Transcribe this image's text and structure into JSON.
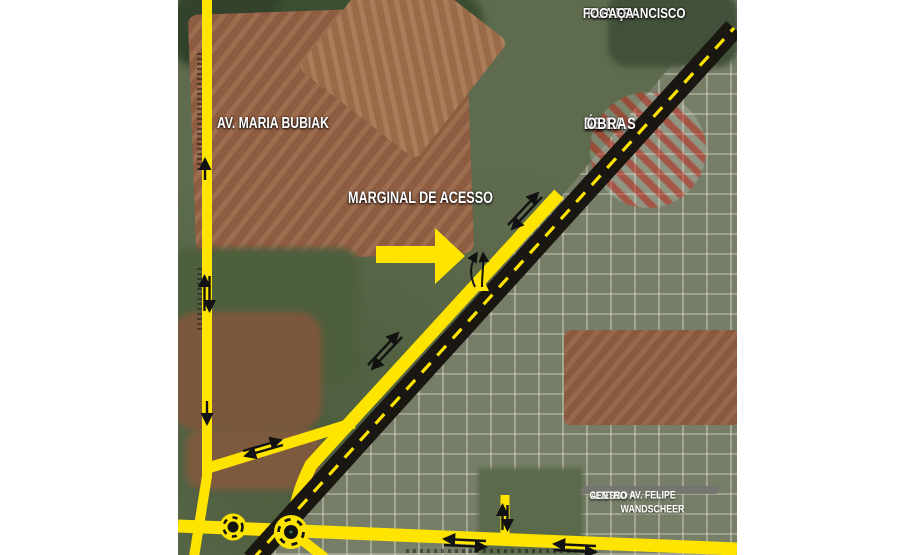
{
  "labels": {
    "rua_francisco": {
      "line1": "RUA FRANCISCO",
      "line2": "FOGAÇA"
    },
    "av_maria_bubiak": "AV. MARIA BUBIAK",
    "marginal_de_acesso": "MARGINAL DE ACESSO",
    "area_obras": {
      "line1": "ÁREA",
      "line2": "DE",
      "line3": "OBRAS"
    },
    "acesso": {
      "line1": "ACESSO A",
      "line2": "AV. FELIPE WANDSCHEER",
      "line3": "CENTRO"
    }
  },
  "colors": {
    "road_yellow": "#ffe400",
    "highway_black": "#1a1712",
    "centerline_dash_yellow": "#ffe400",
    "construction_hatch_red": "#cd3426",
    "label_text_white": "#ffffff",
    "acesso_box_gray": "#767370",
    "page_margin_white": "#ffffff"
  },
  "legend_semantics": {
    "dashed_black_road": "main highway under works",
    "yellow_roads": "diversion / access routes",
    "hatched_circle": "construction works area",
    "roundabouts": 2
  }
}
